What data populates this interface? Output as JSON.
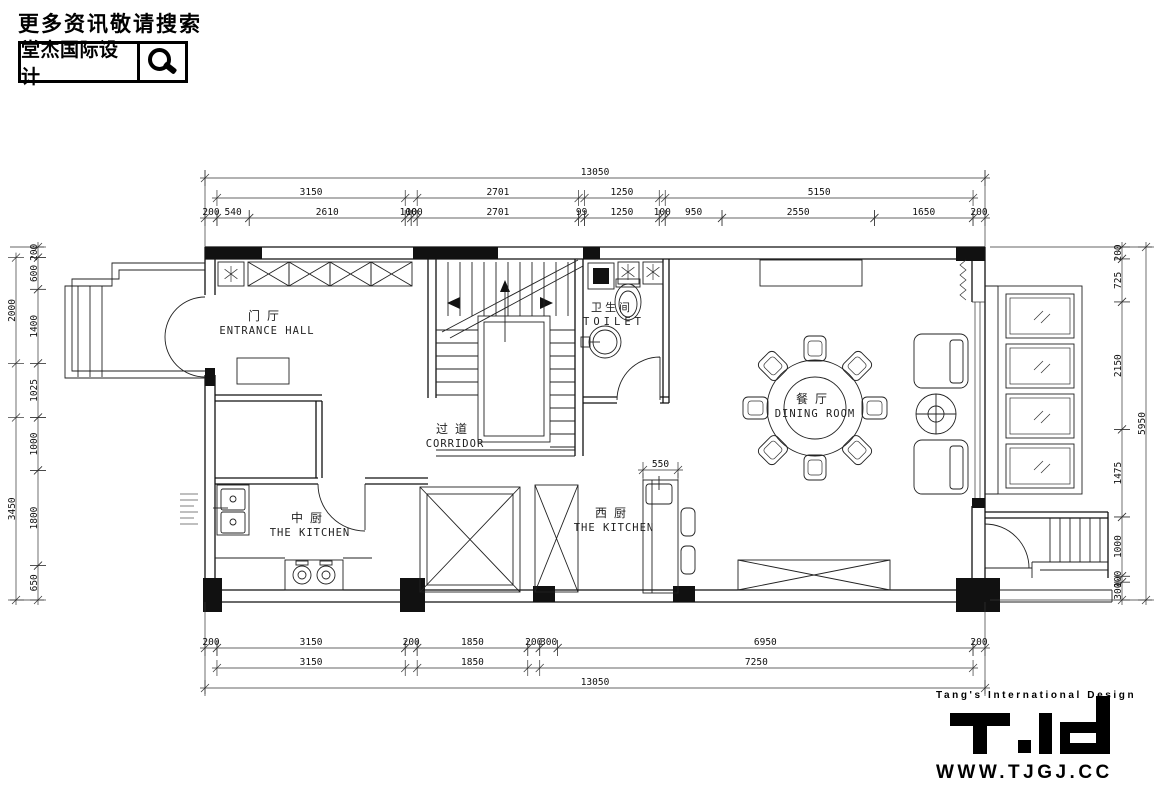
{
  "header": {
    "search_hint": "更多资讯敬请搜索",
    "brand_name": "堂杰国际设计"
  },
  "rooms": [
    {
      "cn": "门厅",
      "en": "ENTRANCE HALL"
    },
    {
      "cn": "过道",
      "en": "CORRIDOR"
    },
    {
      "cn": "卫生间",
      "en": "TOILET"
    },
    {
      "cn": "餐厅",
      "en": "DINING ROOM"
    },
    {
      "cn": "中厨",
      "en": "THE KITCHEN"
    },
    {
      "cn": "西厨",
      "en": "THE KITCHEN"
    }
  ],
  "dimensions": {
    "top_row1": [
      [
        0,
        13050,
        "13050"
      ]
    ],
    "top_row2": [
      [
        200,
        3350,
        "3150"
      ],
      [
        3550,
        6251,
        "2701"
      ],
      [
        6350,
        7600,
        "1250"
      ],
      [
        7700,
        12850,
        "5150"
      ]
    ],
    "top_row3": [
      [
        0,
        200,
        "200"
      ],
      [
        200,
        740,
        "540"
      ],
      [
        740,
        3350,
        "2610"
      ],
      [
        3350,
        3450,
        "100"
      ],
      [
        3450,
        3550,
        "100"
      ],
      [
        3550,
        6251,
        "2701"
      ],
      [
        6251,
        6350,
        "99"
      ],
      [
        6350,
        7600,
        "1250"
      ],
      [
        7600,
        7700,
        "100"
      ],
      [
        7700,
        8650,
        "950"
      ],
      [
        8650,
        11200,
        "2550"
      ],
      [
        11200,
        12850,
        "1650"
      ],
      [
        12850,
        13050,
        "200"
      ]
    ],
    "bottom_row1": [
      [
        0,
        200,
        "200"
      ],
      [
        200,
        3350,
        "3150"
      ],
      [
        3350,
        3550,
        "200"
      ],
      [
        3550,
        5400,
        "1850"
      ],
      [
        5400,
        5600,
        "200"
      ],
      [
        5600,
        5900,
        "300"
      ],
      [
        5900,
        12850,
        "6950"
      ],
      [
        12850,
        13050,
        "200"
      ]
    ],
    "bottom_row2": [
      [
        200,
        3350,
        "3150"
      ],
      [
        3550,
        5400,
        "1850"
      ],
      [
        5600,
        12850,
        "7250"
      ]
    ],
    "bottom_row3": [
      [
        0,
        13050,
        "13050"
      ]
    ],
    "right_inner": [
      [
        0,
        200,
        "200"
      ],
      [
        200,
        925,
        "725"
      ],
      [
        925,
        3075,
        "2150"
      ],
      [
        3075,
        4550,
        "1475"
      ],
      [
        4550,
        5550,
        "1000"
      ],
      [
        5550,
        5650,
        "100"
      ],
      [
        5650,
        5950,
        "300"
      ]
    ],
    "right_outer": [
      [
        0,
        5950,
        "5950"
      ]
    ],
    "left_inner": [
      [
        0,
        200,
        "200"
      ],
      [
        200,
        800,
        "600"
      ],
      [
        800,
        2200,
        "1400"
      ],
      [
        2200,
        3225,
        "1025"
      ],
      [
        3225,
        4225,
        "1000"
      ],
      [
        4225,
        6025,
        "1800"
      ],
      [
        6025,
        6675,
        "650"
      ]
    ],
    "left_outer": [
      [
        200,
        2200,
        "2000"
      ],
      [
        3225,
        6675,
        "3450"
      ]
    ],
    "island": [
      [
        0,
        550,
        "550"
      ]
    ]
  },
  "footer": {
    "tagline": "Tang's International Design",
    "website": "WWW.TJGJ.CC"
  }
}
